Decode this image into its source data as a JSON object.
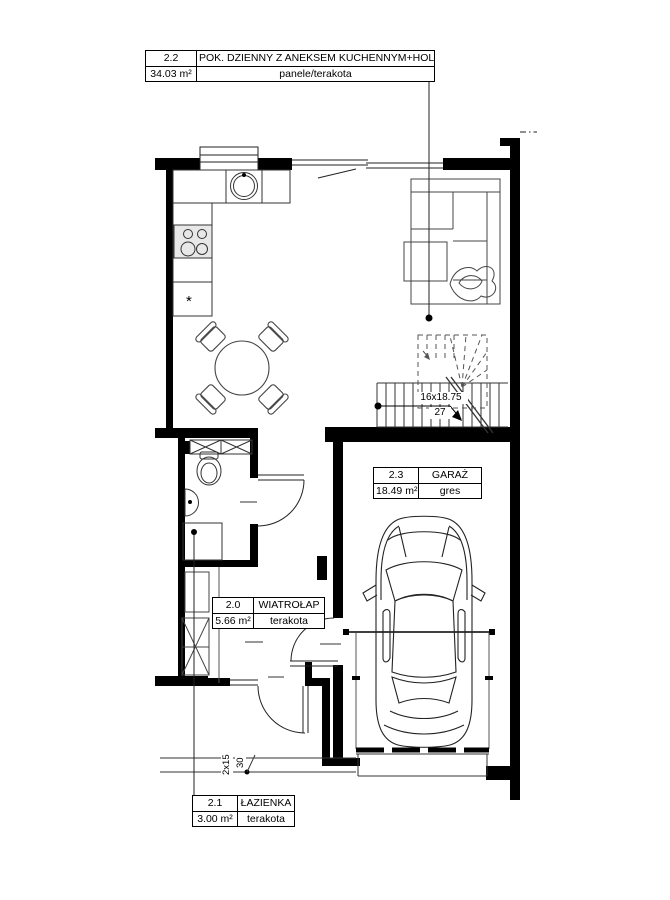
{
  "rooms": [
    {
      "no": "2.2",
      "name": "POK. DZIENNY Z ANEKSEM KUCHENNYM+HOLL",
      "area": "34.03 m²",
      "floor": "panele/terakota"
    },
    {
      "no": "2.3",
      "name": "GARAŻ",
      "area": "18.49 m²",
      "floor": "gres"
    },
    {
      "no": "2.0",
      "name": "WIATROŁAP",
      "area": "5.66 m²",
      "floor": "terakota"
    },
    {
      "no": "2.1",
      "name": "ŁAZIENKA",
      "area": "3.00 m²",
      "floor": "terakota"
    }
  ],
  "dims": {
    "stairs_dim": "16x18.75",
    "stairs_width": "27",
    "entry_riser": "2x15",
    "entry_tread": "30",
    "freezer_symbol": "*"
  }
}
